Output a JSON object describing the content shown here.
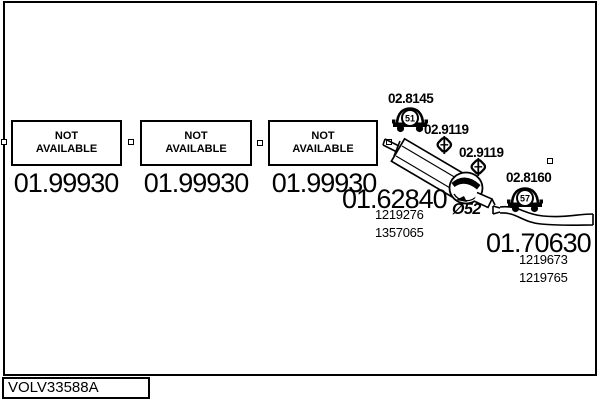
{
  "frame": {
    "code_label": "VOLV33588A"
  },
  "boxes": [
    {
      "title_line1": "NOT",
      "title_line2": "AVAILABLE",
      "price": "01.99930"
    },
    {
      "title_line1": "NOT",
      "title_line2": "AVAILABLE",
      "price": "01.99930"
    },
    {
      "title_line1": "NOT",
      "title_line2": "AVAILABLE",
      "price": "01.99930"
    }
  ],
  "parts": {
    "hanger_front": {
      "label": "02.8145",
      "badge": "51"
    },
    "clamp_front": {
      "label": "02.9119"
    },
    "clamp_mid": {
      "label": "02.9119"
    },
    "hanger_rear": {
      "label": "02.8160",
      "badge": "57"
    },
    "muffler": {
      "price": "01.62840",
      "ref1": "1219276",
      "ref2": "1357065",
      "diameter": "Ø52"
    },
    "tailpipe": {
      "price": "01.70630",
      "ref1": "1219673",
      "ref2": "1219765"
    }
  },
  "colors": {
    "line": "#000000",
    "background": "#ffffff"
  }
}
